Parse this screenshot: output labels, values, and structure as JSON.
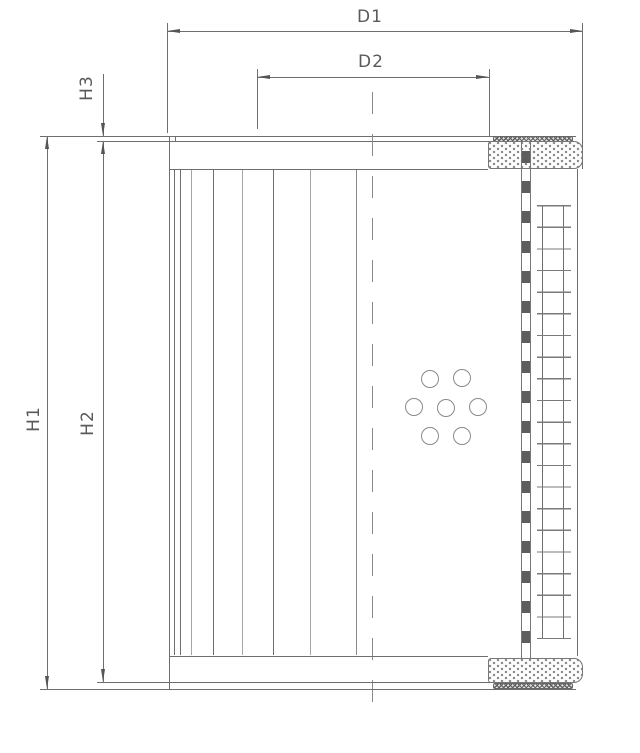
{
  "drawing": {
    "description": "filter-element-section-drawing",
    "dimensions": {
      "d1": "D1",
      "d2": "D2",
      "h1": "H1",
      "h2": "H2",
      "h3": "H3"
    },
    "colors": {
      "background": "#ffffff",
      "line": "#6e6e6e",
      "label": "#5a5a5a",
      "hatch": "#5f5f5f",
      "stipple": "#8c8c8c"
    }
  }
}
